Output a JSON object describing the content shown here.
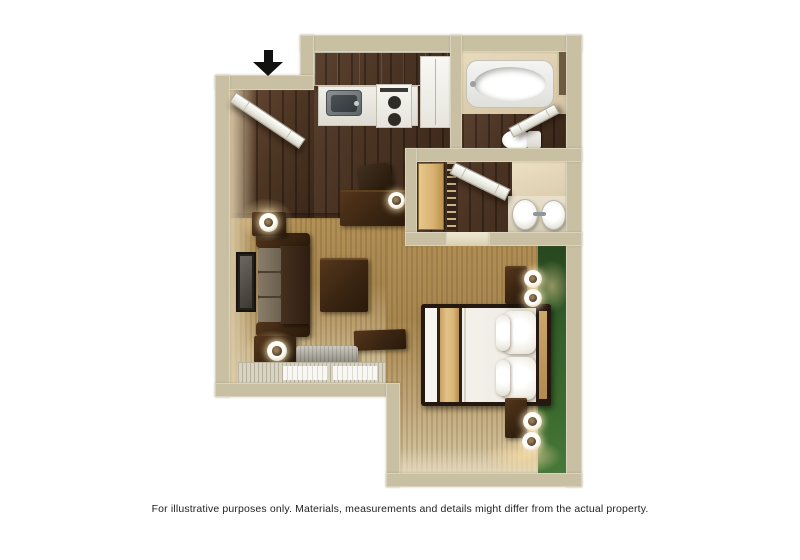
{
  "caption": "For illustrative purposes only.  Materials, measurements and details might differ from the actual property.",
  "entry": {
    "arrow_icon": "entry-arrow-down"
  },
  "colors": {
    "wall": "#c9c0a3",
    "wall_light": "#dcd5bc",
    "wall_face": "#e3d5b6",
    "hardwood": "#4a3323",
    "carpet": "#ab8d5b",
    "carpet_light": "#d7c9a8",
    "accent_green": "#3c6c2f",
    "accent_green_dark": "#27471f",
    "fixture_white": "#f6f5f1",
    "furniture_dark": "#362515",
    "wood_tan": "#dcba7e",
    "cushion": "#7c7160",
    "steel": "#788084",
    "lamp_glow": "#f6d9a2",
    "arrow": "#111111",
    "caption_color": "#1f1f1f"
  },
  "scene": {
    "type": "studio-suite-floor-plan",
    "areas": [
      "entry",
      "kitchen",
      "bathroom",
      "dressing-area",
      "living-area",
      "sleeping-area"
    ],
    "furniture": [
      "entry-door",
      "upper-cabinets",
      "kitchen-sink",
      "stove",
      "refrigerator",
      "bathtub",
      "toilet",
      "bathroom-door",
      "wardrobe",
      "closet-rail",
      "dressing-door",
      "vanity-double-sink",
      "sofa",
      "tv",
      "coffee-table",
      "desk",
      "desk-chair",
      "desk-lamp",
      "side-tables",
      "table-lamps",
      "window-blinds",
      "heater-unit",
      "ottoman",
      "bed",
      "headboard",
      "pillows",
      "nightstands",
      "bedside-lamps",
      "green-accent-wall"
    ]
  }
}
